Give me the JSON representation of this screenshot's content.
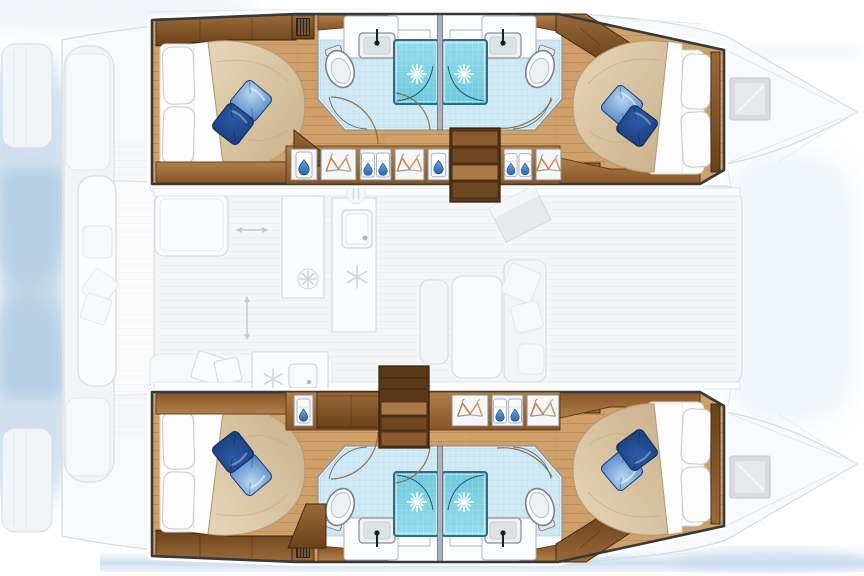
{
  "scene": {
    "description": "Top-view illustrated floor plan of a sailing catamaran: two hulls each with two double cabins and two bathrooms with showers; central salon with galley, aft cockpit and foredeck drawn faded.",
    "orientation": {
      "bow": "right",
      "stern": "left"
    }
  },
  "counts": {
    "cabins": 4,
    "double_beds": 4,
    "bathrooms": 4,
    "showers": 4,
    "toilets": 4,
    "sinks": 4,
    "stairways": 2,
    "deck_hatches": 2
  },
  "layout": {
    "hulls": [
      {
        "id": "top-hull",
        "cabins": [
          {
            "id": "top-aft-cabin",
            "type": "double-berth",
            "white_pillows": 2,
            "blue_pillows": 2
          },
          {
            "id": "top-forward-cabin",
            "type": "double-berth",
            "white_pillows": 2,
            "blue_pillows": 2
          }
        ],
        "bathrooms": [
          {
            "id": "top-aft-bathroom",
            "fixtures": [
              "toilet",
              "sink",
              "shower"
            ]
          },
          {
            "id": "top-forward-bathroom",
            "fixtures": [
              "toilet",
              "sink",
              "shower"
            ]
          }
        ],
        "companionway": {
          "stairs_steps": 4,
          "wardrobes": [
            "water-drop locker",
            "hanging locker",
            "linen shelves",
            "hanging locker",
            "water-drop locker",
            "linen shelves",
            "hanging locker"
          ],
          "vents": 2
        }
      },
      {
        "id": "bottom-hull",
        "cabins": [
          {
            "id": "bottom-aft-cabin",
            "type": "double-berth",
            "white_pillows": 2,
            "blue_pillows": 2
          },
          {
            "id": "bottom-forward-cabin",
            "type": "double-berth",
            "white_pillows": 2,
            "blue_pillows": 2
          }
        ],
        "bathrooms": [
          {
            "id": "bottom-aft-bathroom",
            "fixtures": [
              "toilet",
              "sink",
              "shower"
            ]
          },
          {
            "id": "bottom-forward-bathroom",
            "fixtures": [
              "toilet",
              "sink",
              "shower"
            ]
          }
        ],
        "companionway": {
          "stairs_steps": 4,
          "wardrobes": [
            "linen locker",
            "cabinet",
            "hanging locker",
            "linen shelves",
            "hanging locker"
          ],
          "vents": 2
        }
      }
    ],
    "bridge_deck_faded": {
      "aft_cockpit": [
        "bench seating",
        "cushions",
        "throw pillows",
        "table"
      ],
      "salon": [
        "galley counters",
        "sinks",
        "burner",
        "freezer",
        "dining table",
        "sofa",
        "chart table"
      ],
      "foredeck": [
        "deck hatches",
        "bow lines"
      ]
    }
  },
  "icons": [
    {
      "name": "shower-sunburst-icon"
    },
    {
      "name": "toilet-icon"
    },
    {
      "name": "sink-faucet-icon"
    },
    {
      "name": "clothes-hanger-icon"
    },
    {
      "name": "linen-with-drop-icon"
    },
    {
      "name": "water-drop-icon"
    },
    {
      "name": "vent-grille-icon"
    },
    {
      "name": "stairs-icon"
    },
    {
      "name": "snowflake-icon"
    },
    {
      "name": "burner-icon"
    },
    {
      "name": "cutlery-icon"
    },
    {
      "name": "double-arrow-icon"
    }
  ],
  "colors": {
    "background": "#ffffff",
    "wash_blue": "#a3c2de",
    "water_band": "#c8dcef",
    "trampoline_wash": "#dce7f1",
    "hull_outline": "#35383c",
    "wall_line": "#8d949b",
    "floor_plank": "#cfa06a",
    "floor_plank_line": "#b0814e",
    "wood_cabinet_light": "#9a6a38",
    "wood_cabinet_dark": "#6b411a",
    "wood_counter_light": "#b08048",
    "wood_counter_dark": "#875427",
    "wood_frame_dark": "#3d2610",
    "stair_tread_light": "#a97a45",
    "stair_tread_mid": "#8a5a2e",
    "stair_tread_dark": "#6f4720",
    "duvet_light": "#e6d6b8",
    "duvet_dark": "#c9b08a",
    "duvet_outline": "#b49a74",
    "sheet_white": "#fdfdfd",
    "pillow_outline": "#c6cacd",
    "pillow_blue_light": "#b9d8f2",
    "pillow_blue_mid": "#4a7fc0",
    "pillow_blue_dark": "#2d5ba6",
    "pillow_blue_deep": "#173c7a",
    "bath_floor": "#cfeaf5",
    "bath_grid": "#aed4e4",
    "shower_light": "#93dcec",
    "shower_dark": "#6cc8dc",
    "shower_border": "#2e6b80",
    "fixture_white": "#fbfcfd",
    "fixture_outline": "#79828a",
    "sink_basin": "#dde2e5",
    "faucet_black": "#1b1d1f",
    "hanger_orange": "#c87e3a",
    "hanger_steel": "#8f969c",
    "drop_blue": "#2b62ae",
    "vent_dark": "#2c2216",
    "vent_line": "#c9a36e",
    "door_arc": "#8a623b",
    "hatch_gray": "#d9dcdf",
    "faded_fill": "#f2f4f6",
    "faded_fill_bright": "#fafbfc",
    "faded_stroke": "#d5dbe0",
    "faded_stroke_soft": "#e3e8ec",
    "faded_icon": "#cfd6dc"
  }
}
